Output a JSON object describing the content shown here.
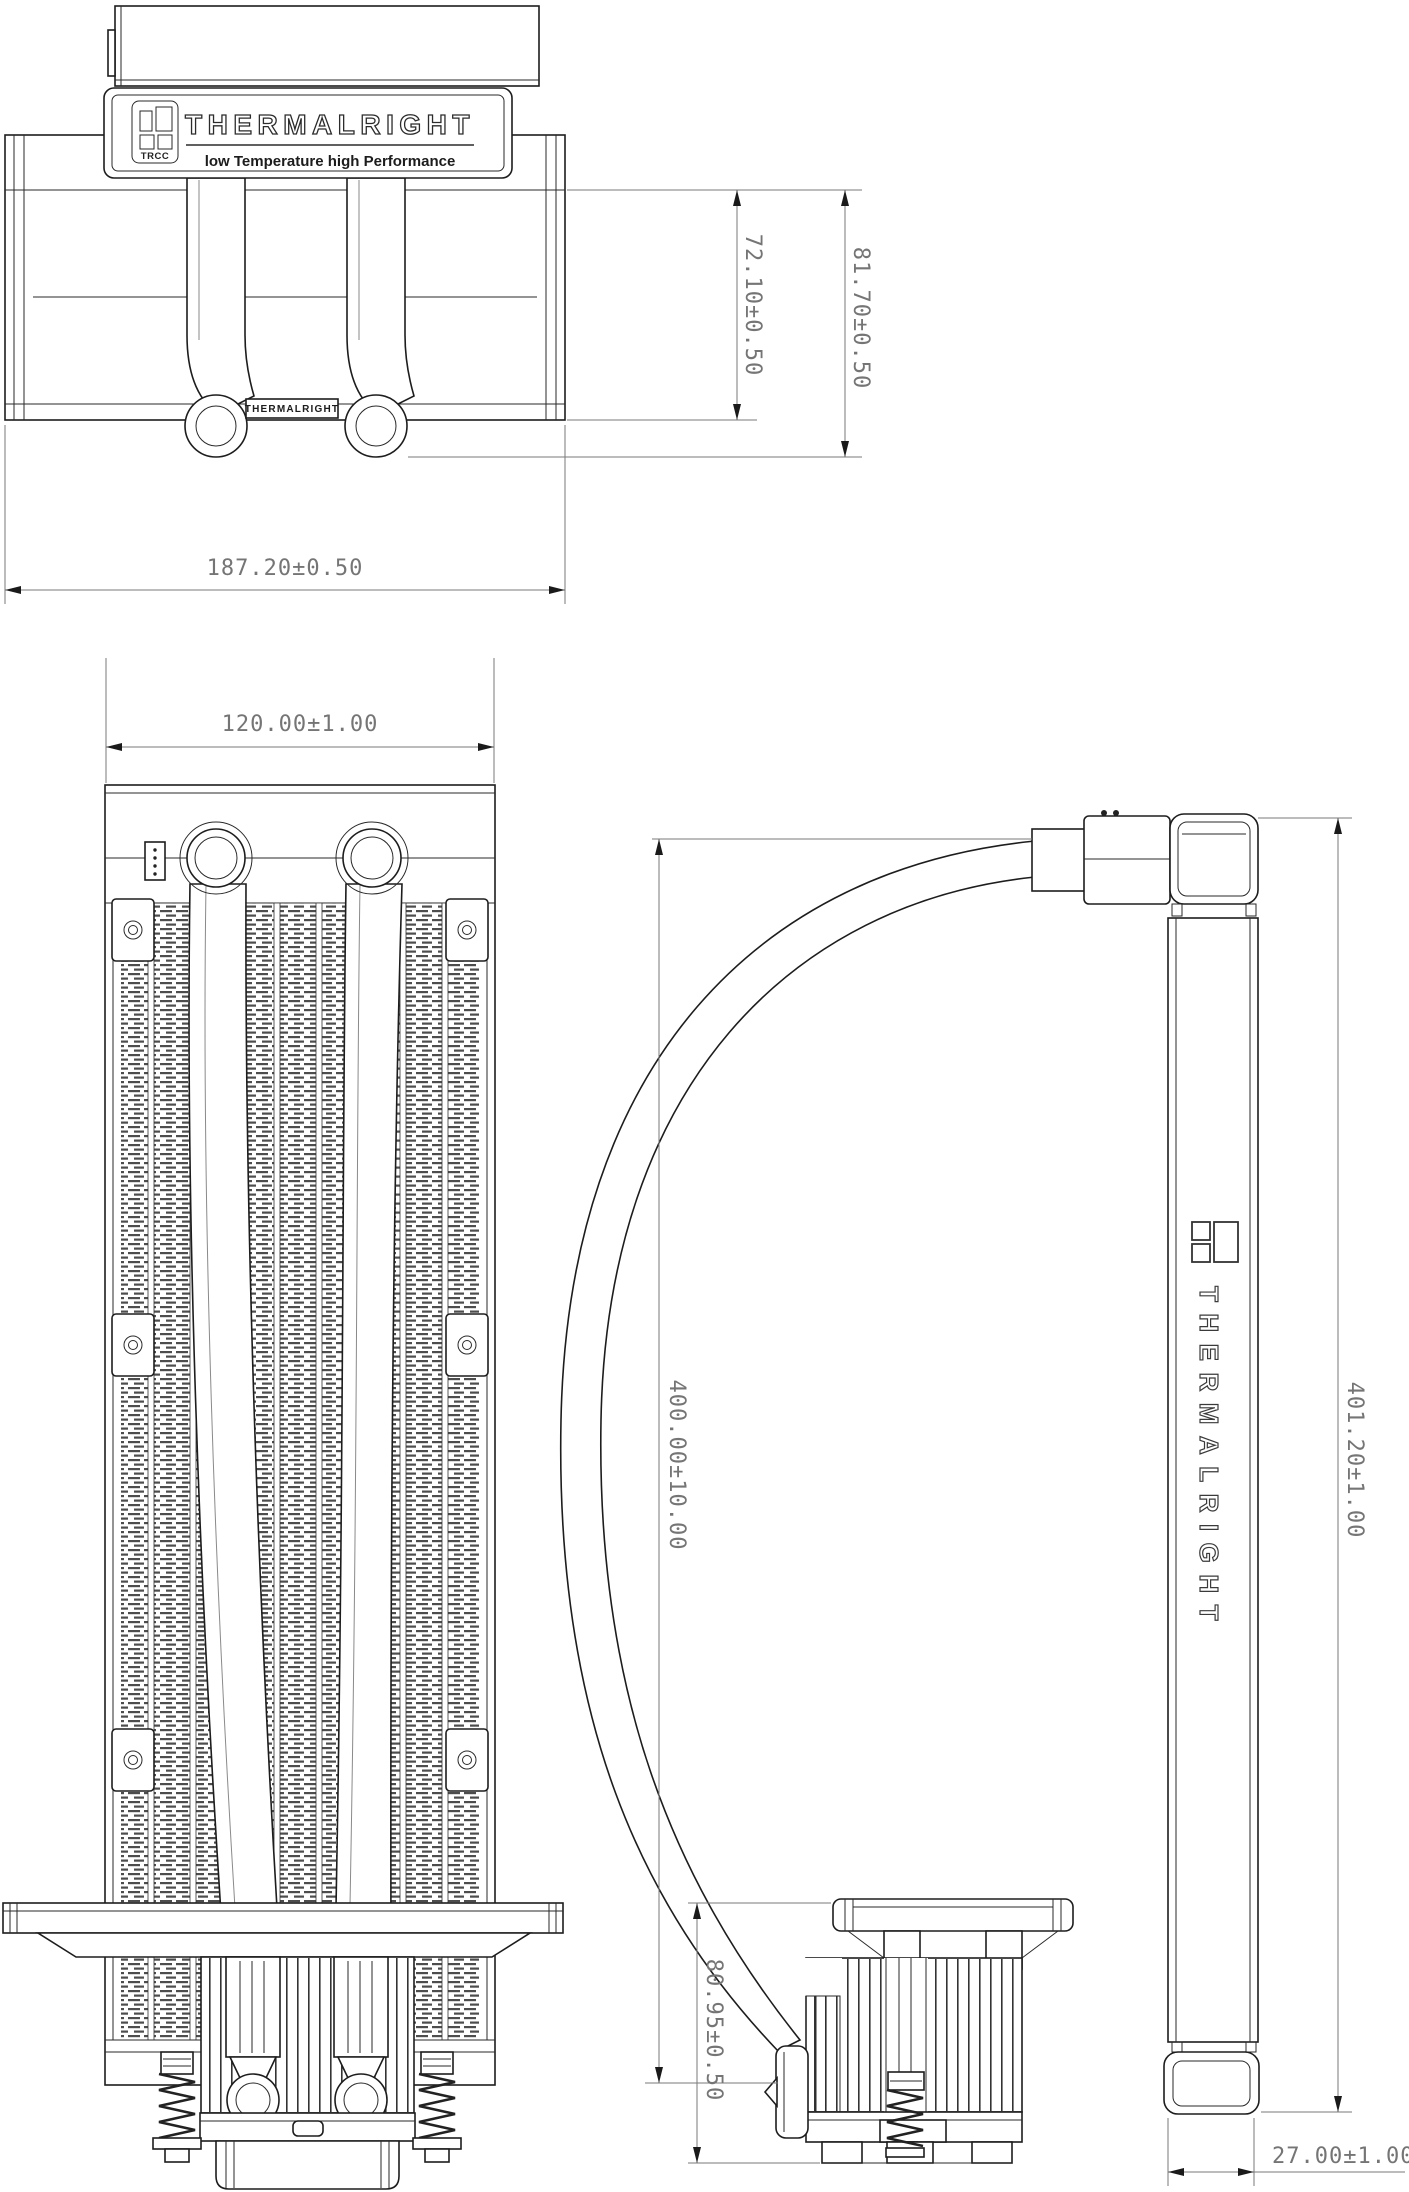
{
  "drawing": {
    "brand": {
      "name": "THERMALRIGHT",
      "badge": "TRCC",
      "tagline": "low Temperature high Performance",
      "pump_label": "THERMALRIGHT"
    },
    "top_view": {
      "dim_body_height": "72.10±0.50",
      "dim_overall_height": "81.70±0.50",
      "dim_width": "187.20±0.50"
    },
    "front_view": {
      "dim_width": "120.00±1.00"
    },
    "side_view": {
      "brand_vertical": "THERMALRIGHT",
      "dim_height": "400.00±10.00",
      "dim_overall_height": "401.20±1.00",
      "dim_pump_height": "80.95±0.50",
      "dim_thickness": "27.00±1.00"
    },
    "colors": {
      "line": "#1d1d1d",
      "dimension": "#757575",
      "background": "#ffffff"
    }
  }
}
